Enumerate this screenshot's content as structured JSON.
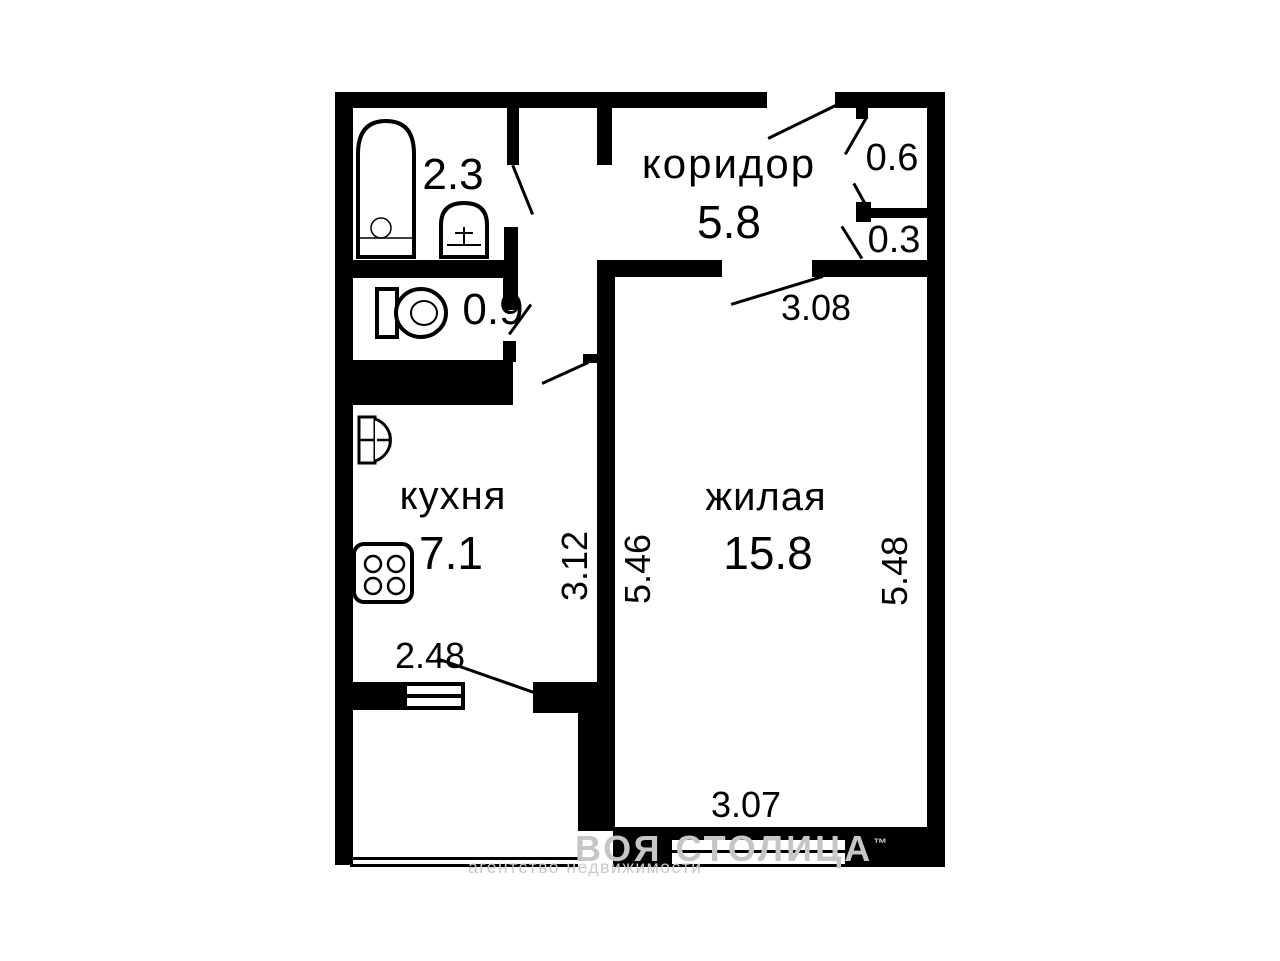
{
  "floorplan": {
    "rooms": {
      "corridor": {
        "name": "коридор",
        "area": "5.8"
      },
      "bathroom": {
        "area": "2.3"
      },
      "toilet": {
        "area": "0.9"
      },
      "closet_top": {
        "area": "0.6"
      },
      "closet_bottom": {
        "area": "0.3"
      },
      "kitchen": {
        "name": "кухня",
        "area": "7.1"
      },
      "living_room": {
        "name": "жилая",
        "area": "15.8"
      }
    },
    "dimensions": {
      "living_top_width": "3.08",
      "kitchen_depth": "3.12",
      "living_depth_left": "5.46",
      "living_depth_right": "5.48",
      "kitchen_bottom_width": "2.48",
      "living_bottom_width": "3.07"
    },
    "watermark": {
      "line1": "ВОЯ СТОЛИЦА",
      "trademark": "™",
      "line2": "агентство недвижимости"
    },
    "colors": {
      "wall": "#000000",
      "background": "#ffffff",
      "watermark": "#c6c6c6"
    }
  }
}
